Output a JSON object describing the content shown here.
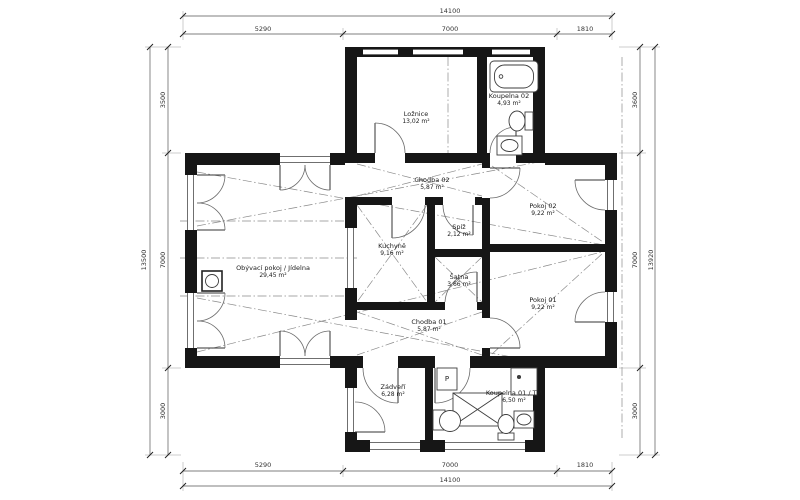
{
  "plan": {
    "title": "family-house-floor-plan",
    "rooms": [
      {
        "name": "Ložnice",
        "area": "13,02 m²"
      },
      {
        "name": "Koupelna 02",
        "area": "4,93 m²"
      },
      {
        "name": "Chodba 02",
        "area": "5,87 m²"
      },
      {
        "name": "Pokoj 02",
        "area": "9,22 m²"
      },
      {
        "name": "Kuchyně",
        "area": "9,16 m²"
      },
      {
        "name": "Spíž",
        "area": "2,12 m²"
      },
      {
        "name": "Šatna",
        "area": "3,66 m²"
      },
      {
        "name": "Obývací pokoj / Jídelna",
        "area": "29,45 m²"
      },
      {
        "name": "Pokoj 01",
        "area": "9,22 m²"
      },
      {
        "name": "Chodba 01",
        "area": "5,87 m²"
      },
      {
        "name": "Zádveří",
        "area": "6,28 m²"
      },
      {
        "name": "Koupelna 01 / TM",
        "area": "6,50 m²"
      }
    ],
    "dimensions": {
      "top": {
        "total": "14100",
        "segments": [
          "5290",
          "7000",
          "1810"
        ]
      },
      "bottom": {
        "total": "14100",
        "segments": [
          "5290",
          "7000",
          "1810"
        ]
      },
      "left": {
        "total": "13500",
        "segments": [
          "3500",
          "7000",
          "3000"
        ]
      },
      "right": {
        "total": "13920",
        "segments": [
          "3600",
          "7000",
          "3000"
        ]
      }
    },
    "fixtures": {
      "washer_label": "P"
    },
    "colors": {
      "wall": "#161616",
      "line": "#666666",
      "dim": "#444444"
    }
  }
}
